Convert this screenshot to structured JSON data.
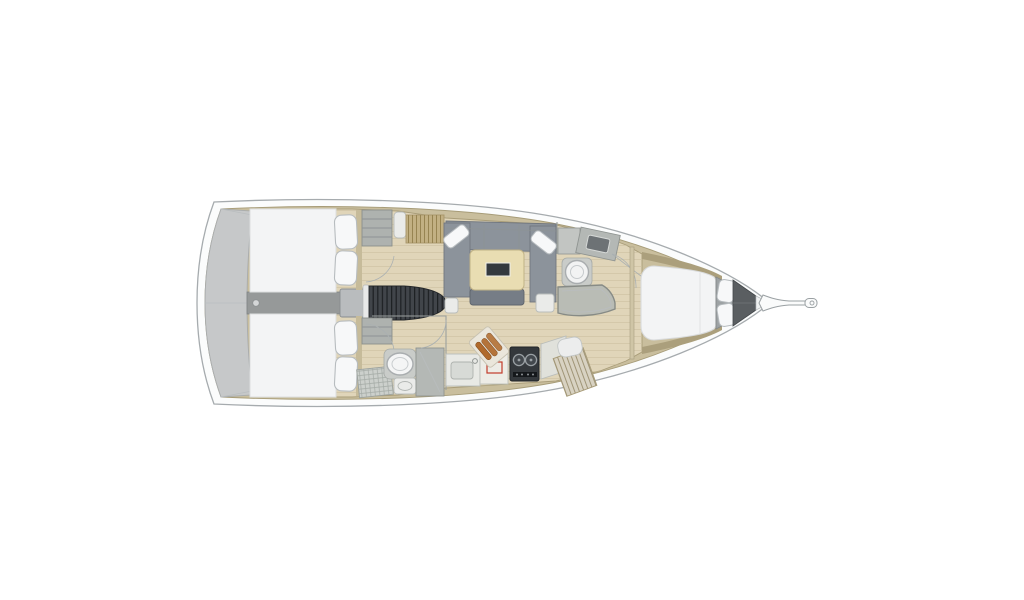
{
  "scene": {
    "kind": "sailboat-interior-floor-plan",
    "orientation": "bow-right-stern-left"
  },
  "palette": {
    "background": "#ffffff",
    "hull_outline": "#a6abae",
    "hull_rim": "#fbfcfc",
    "deck_band": "#c9be9d",
    "deck_band_edge": "#a79c78",
    "floor_wood": "#e0d5b9",
    "floor_plank_line": "#ccc0a0",
    "transom_platform": "#c6c8c9",
    "walkway_gray": "#969999",
    "engine_box": "#b9bcbe",
    "stairs_dark": "#41454a",
    "stairs_rib": "#1e2124",
    "sofa_gray": "#8c939b",
    "sofa_shadow": "#767d86",
    "cushion_white": "#f7f8f9",
    "pillow_outline": "#b7bcbf",
    "table_wood": "#e9ddb2",
    "table_inset": "#34393e",
    "bed_white": "#f3f4f5",
    "berth_panel": "#9da2a4",
    "anchor_locker": "#5a5e61",
    "teak_slats": "#c2b083",
    "teak_line": "#978452",
    "wardrobe_gray": "#aeb2af",
    "cabinet_white": "#eaebe9",
    "fixture_gray": "#b4b8b5",
    "shower_pan": "#b9bcb5",
    "stove_dark": "#34383c",
    "copper": "#b06a2c",
    "accent_red": "#c23b2a",
    "headboard_wood": "#c6bb9a"
  }
}
